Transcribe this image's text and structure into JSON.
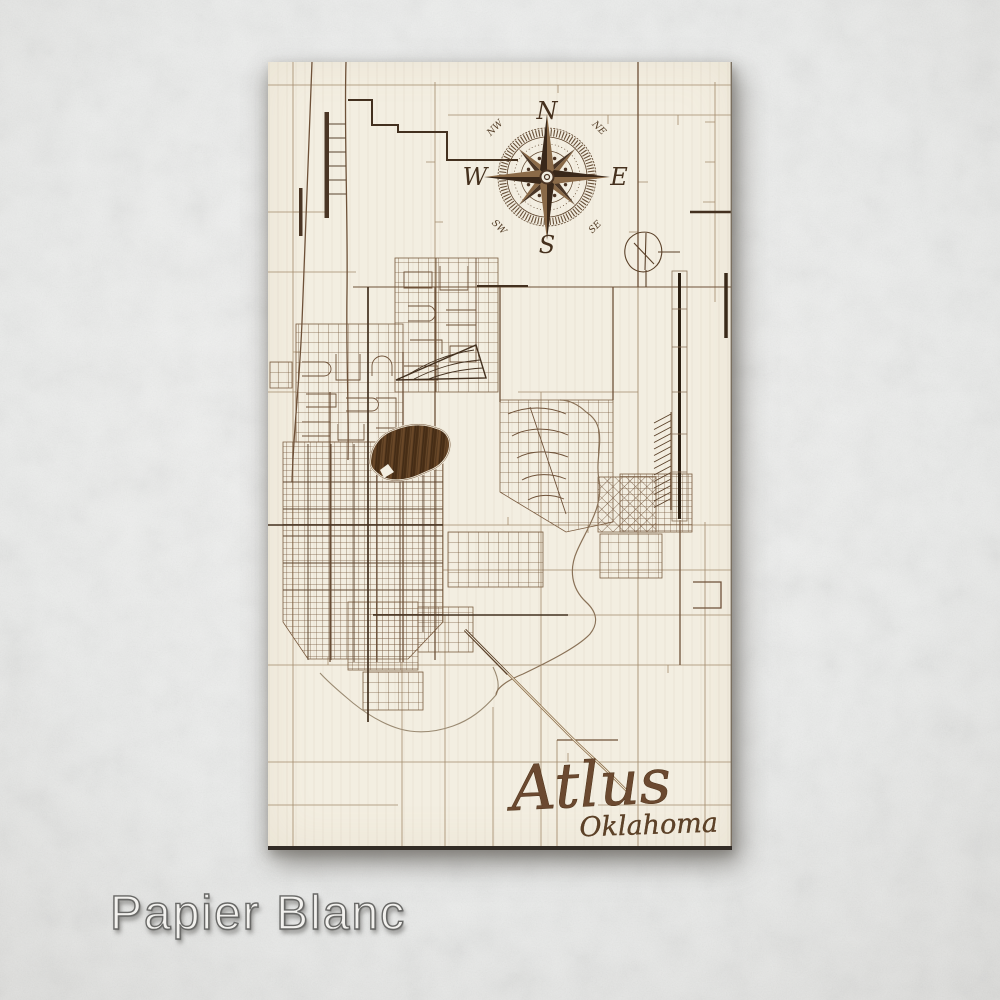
{
  "product": {
    "map_title": "Atlus",
    "map_state": "Oklahoma",
    "finish_name": "Papier Blanc"
  },
  "compass": {
    "north": "N",
    "east": "E",
    "south": "S",
    "west": "W",
    "northwest": "NW",
    "northeast": "NE",
    "southwest": "SW",
    "southeast": "SE"
  },
  "colors": {
    "paper_background": "#eeefee",
    "board_background": "#f3eee1",
    "road_dark": "#43301f",
    "road_medium": "#6e5138",
    "road_light": "#a38a6c",
    "water_wood_fill": "#54381e",
    "title_brown": "#6b4930",
    "finish_label_gray": "#686866"
  }
}
